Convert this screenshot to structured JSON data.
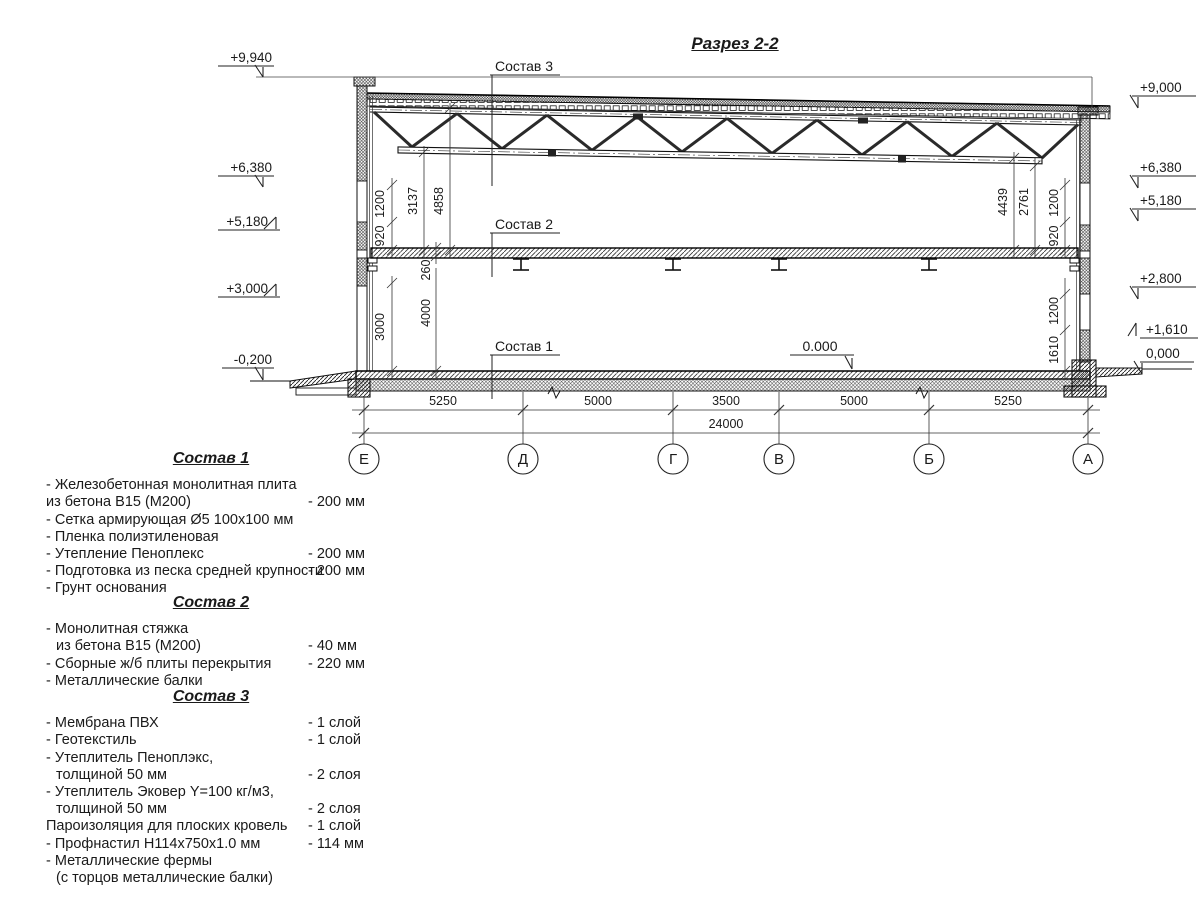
{
  "title": "Разрез 2-2",
  "drawing": {
    "callout1": "Состав 1",
    "callout2": "Состав 2",
    "callout3": "Состав 3",
    "zero_floor": "0.000",
    "elev_left": {
      "e9940": "+9,940",
      "e6380": "+6,380",
      "e5180": "+5,180",
      "e3000": "+3,000",
      "em0200": "-0,200"
    },
    "elev_right": {
      "e9000": "+9,000",
      "e6380": "+6,380",
      "e5180": "+5,180",
      "e2800": "+2,800",
      "e1610": "+1,610",
      "e0000": "0,000"
    },
    "vdim_left": {
      "d1200": "1200",
      "d920": "920",
      "d3137": "3137",
      "d4858": "4858",
      "d260": "260",
      "d4000": "4000",
      "d3000": "3000"
    },
    "vdim_right": {
      "d4439": "4439",
      "d2761": "2761",
      "d1200a": "1200",
      "d920": "920",
      "d1200b": "1200",
      "d1610": "1610"
    },
    "hdims": {
      "s1": "5250",
      "s2": "5000",
      "s3": "3500",
      "s4": "5000",
      "s5": "5250",
      "total": "24000"
    },
    "axes": {
      "a1": "Е",
      "a2": "Д",
      "a3": "Г",
      "a4": "В",
      "a5": "Б",
      "a6": "А"
    }
  },
  "compositions": [
    {
      "title": "Состав 1",
      "items": [
        {
          "l1": "- Железобетонная  монолитная плита"
        },
        {
          "l1": "из бетона  В15 (М200)",
          "value": "- 200 мм"
        },
        {
          "l1": "- Сетка армирующая Ø5 100х100 мм"
        },
        {
          "l1": "- Пленка полиэтиленовая"
        },
        {
          "l1": "- Утепление Пеноплекс",
          "value": "- 200 мм"
        },
        {
          "l1": "- Подготовка из песка средней  крупности",
          "value": "- 200 мм"
        },
        {
          "l1": "- Грунт основания"
        }
      ]
    },
    {
      "title": "Состав 2",
      "items": [
        {
          "l1": "- Монолитная стяжка"
        },
        {
          "l1": "из бетона В15 (М200)",
          "value": "- 40 мм",
          "indent": true
        },
        {
          "l1": "- Сборные ж/б плиты перекрытия",
          "value": "- 220 мм"
        },
        {
          "l1": "- Металлические балки"
        }
      ]
    },
    {
      "title": "Состав 3",
      "items": [
        {
          "l1": "- Мембрана ПВХ",
          "value": "- 1 слой"
        },
        {
          "l1": "- Геотекстиль",
          "value": "- 1 слой"
        },
        {
          "l1": "- Утеплитель Пеноплэкс,"
        },
        {
          "l1": "толщиной 50 мм",
          "value": "- 2 слоя",
          "indent": true
        },
        {
          "l1": "- Утеплитель Эковер Y=100 кг/м3,"
        },
        {
          "l1": "толщиной 50 мм",
          "value": "- 2 слоя",
          "indent": true
        },
        {
          "l1": "Пароизоляция для плоских кровель",
          "value": "- 1 слой"
        },
        {
          "l1": "- Профнастил Н114х750х1.0 мм",
          "value": "- 114 мм"
        },
        {
          "l1": "- Металлические фермы"
        },
        {
          "l1": "(с торцов металлические балки)",
          "indent": true
        }
      ]
    }
  ]
}
